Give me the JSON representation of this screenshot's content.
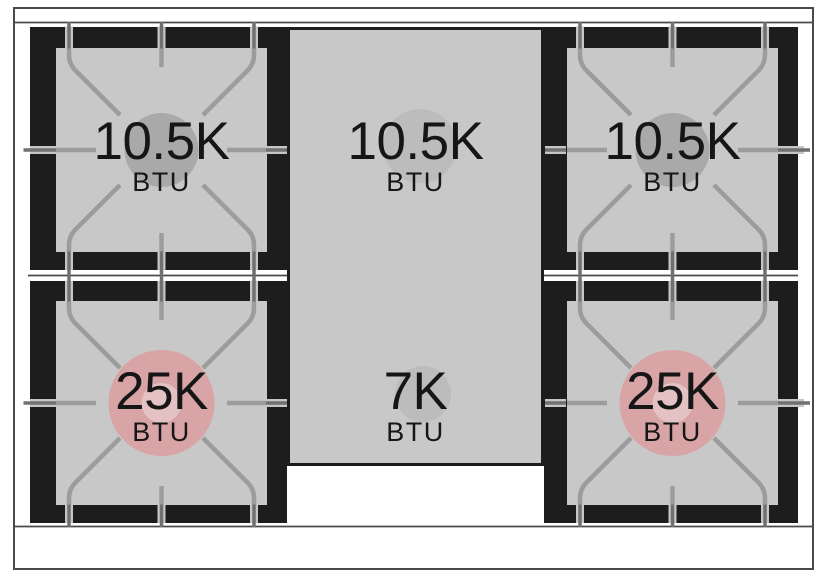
{
  "diagram": {
    "title": "Gas range cooktop burner layout",
    "unit": "BTU",
    "burners": [
      {
        "position": "top-left",
        "output": "10.5K",
        "unit": "BTU",
        "btu": 10500,
        "circle_color": "#a9a9a9"
      },
      {
        "position": "top-center",
        "output": "10.5K",
        "unit": "BTU",
        "btu": 10500,
        "circle_color": "#bcbcbc"
      },
      {
        "position": "top-right",
        "output": "10.5K",
        "unit": "BTU",
        "btu": 10500,
        "circle_color": "#a9a9a9"
      },
      {
        "position": "bottom-left",
        "output": "25K",
        "unit": "BTU",
        "btu": 25000,
        "circle_color": "#d8a4a6"
      },
      {
        "position": "bottom-center",
        "output": "7K",
        "unit": "BTU",
        "btu": 7000,
        "circle_color": "#bcbcbc"
      },
      {
        "position": "bottom-right",
        "output": "25K",
        "unit": "BTU",
        "btu": 25000,
        "circle_color": "#d8a4a6"
      }
    ],
    "colors": {
      "surface_gray": "#c8c8c8",
      "burner_well_black": "#1d1d1d",
      "grate_line": "#9c9c9c",
      "high_output_ring": "#d8a4a6",
      "high_output_cap": "#e4c2c3",
      "standard_ring": "#a9a9a9",
      "griddle_ring": "#bcbcbc",
      "frame_line": "#4a4a4a",
      "text": "#161616",
      "background": "#ffffff"
    }
  }
}
